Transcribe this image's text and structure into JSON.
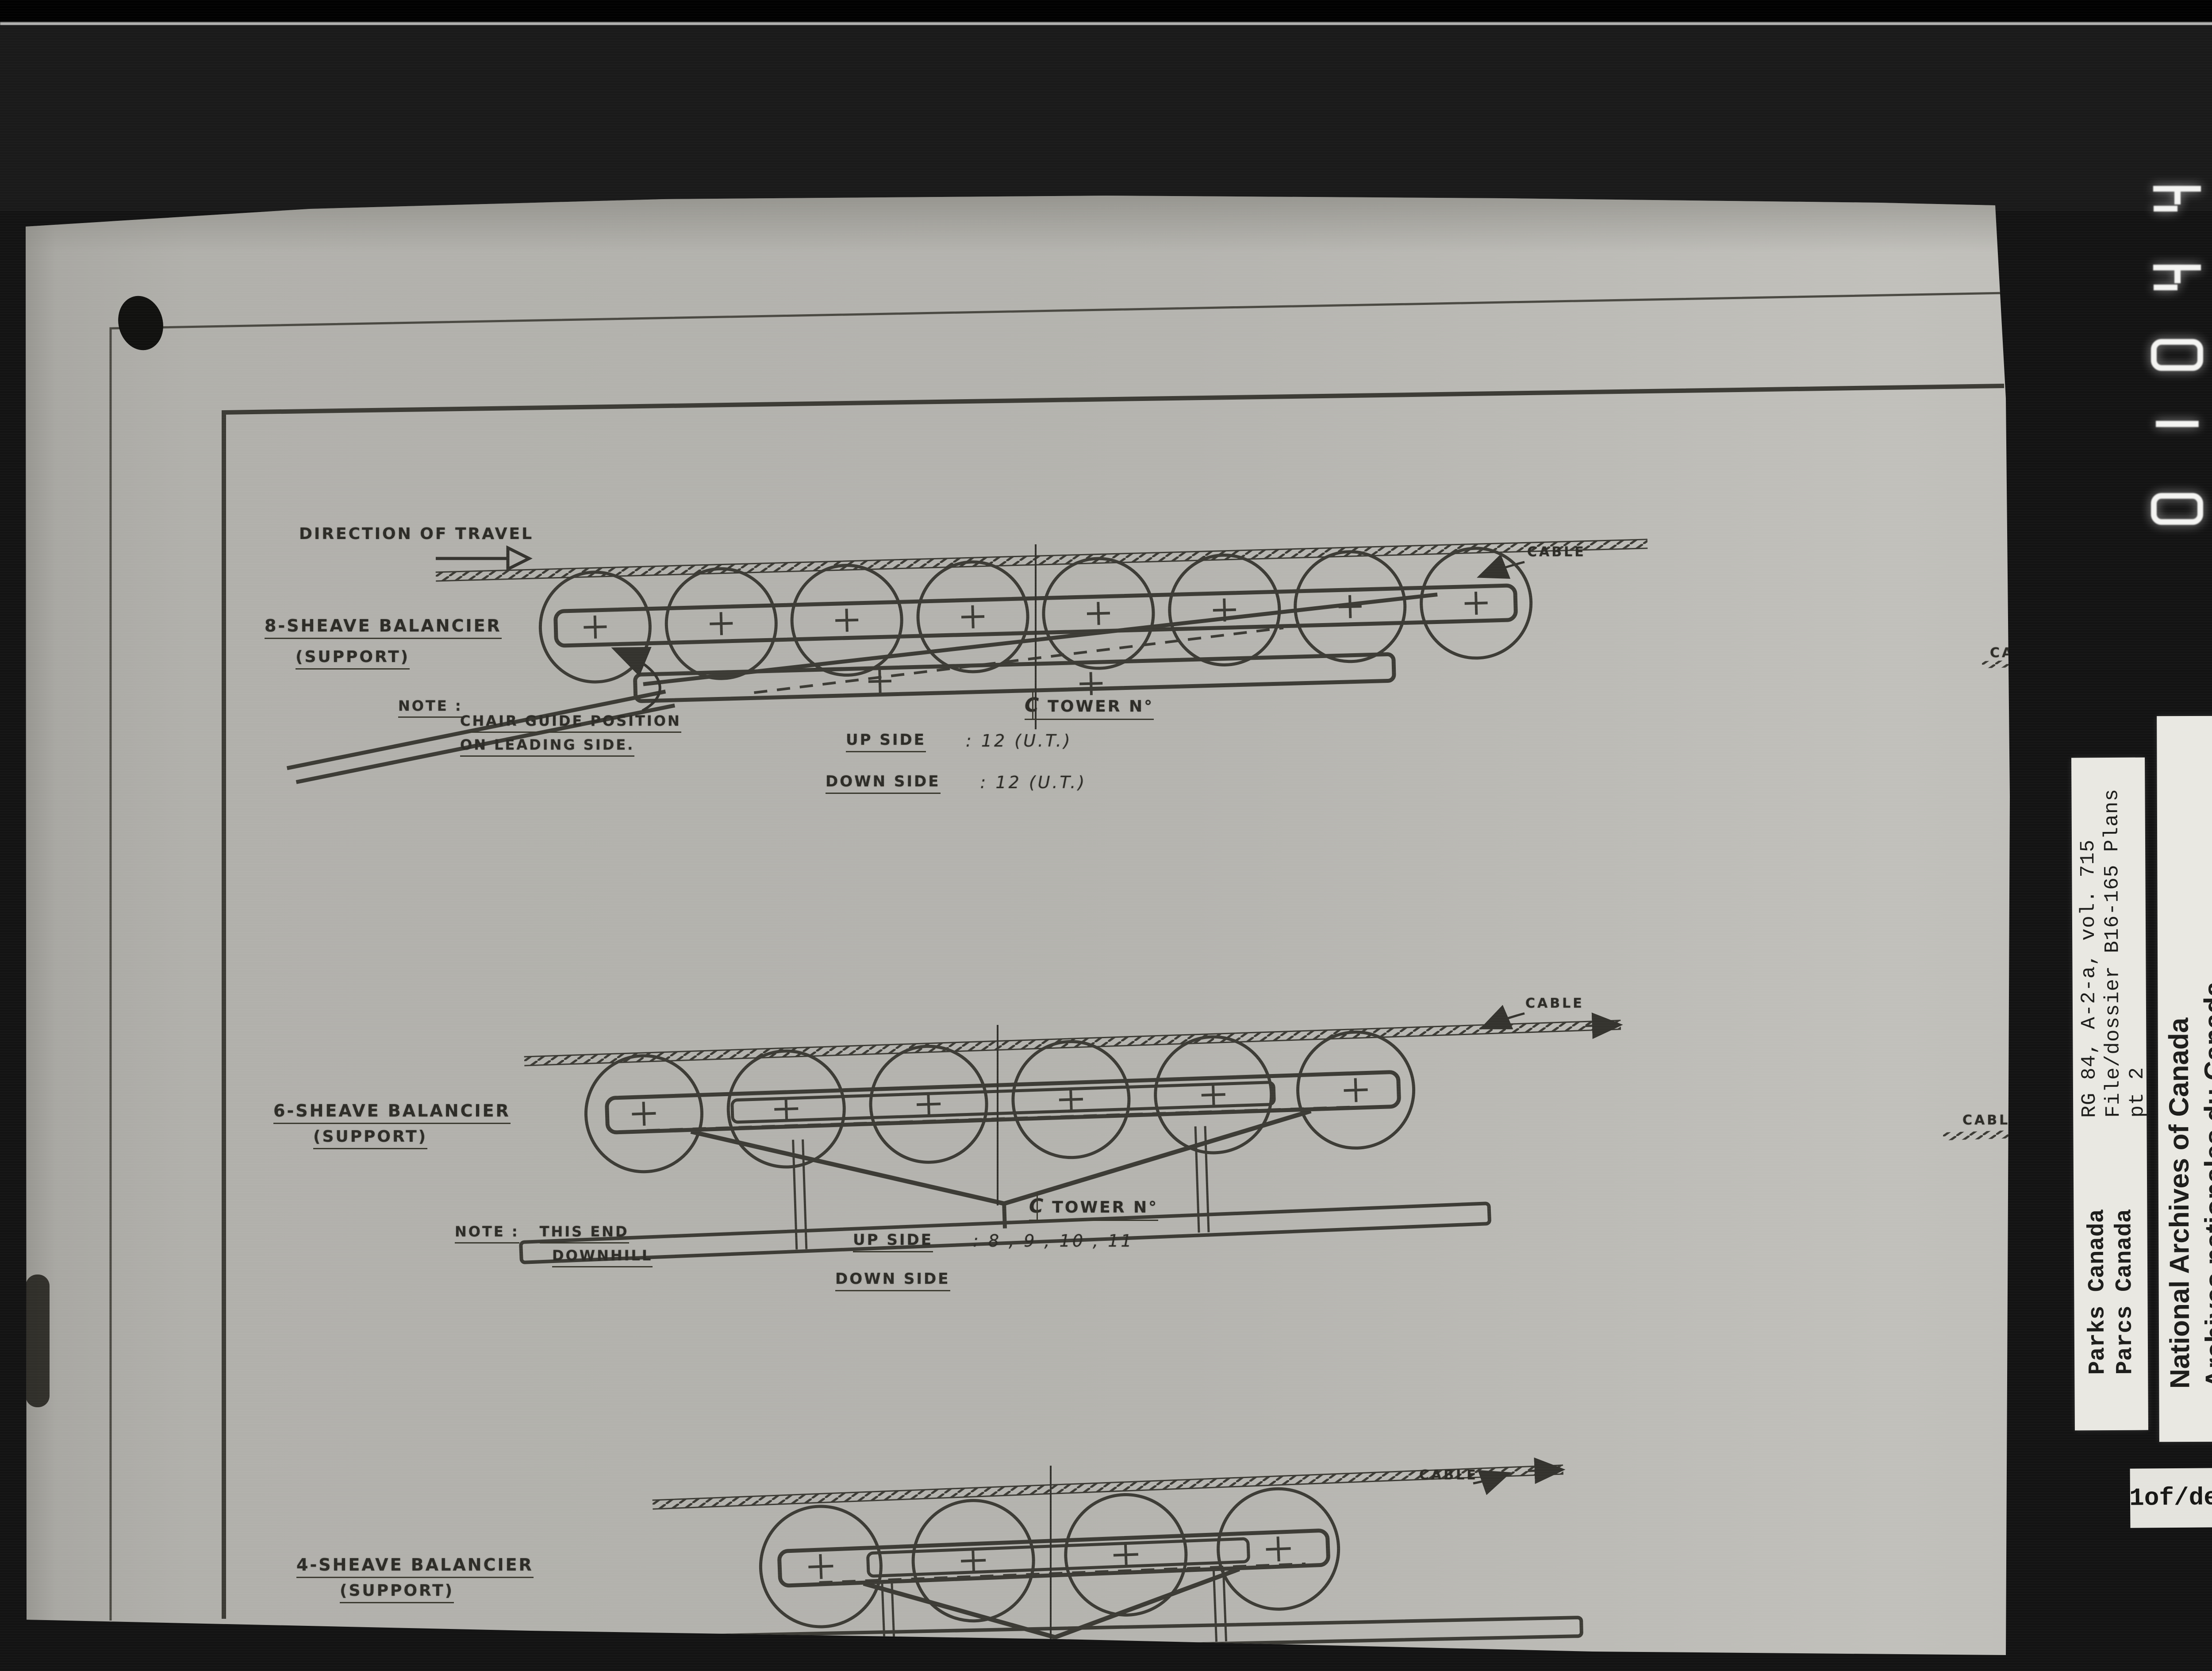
{
  "film": {
    "digits": [
      "4",
      "4",
      "0",
      "1",
      "0"
    ],
    "page_label": "1of/de"
  },
  "archive_labels": {
    "reference": [
      "RG 84, A-2-a, vol. 715",
      "File/dossier B16-165 Plans",
      "pt 2"
    ],
    "agency": [
      "Parks Canada",
      "Parcs Canada"
    ],
    "institution": [
      "National Archives of Canada",
      "Archives nationales du Canada"
    ]
  },
  "drawing": {
    "direction_label": "DIRECTION OF TRAVEL",
    "cable_label": "CABLE",
    "centerline_symbol": "C",
    "diagrams": [
      {
        "title": "8-SHEAVE BALANCIER",
        "subtitle": "(SUPPORT)",
        "tower_label": "TOWER  N°",
        "up_label": "UP  SIDE",
        "up_value": ":  12 (U.T.)",
        "down_label": "DOWN  SIDE",
        "down_value": ":  12 (U.T.)",
        "note_label": "NOTE :",
        "note_line1": "CHAIR GUIDE POSITION",
        "note_line2": "ON LEADING SIDE."
      },
      {
        "title": "6-SHEAVE BALANCIER",
        "subtitle": "(SUPPORT)",
        "tower_label": "TOWER  N°",
        "up_label": "UP  SIDE",
        "up_value": ":  8 , 9 , 10 , 11",
        "down_label": "DOWN  SIDE",
        "down_value": "",
        "note_label": "NOTE :",
        "note_line1": "THIS  END",
        "note_line2": "DOWNHILL"
      },
      {
        "title": "4-SHEAVE BALANCIER",
        "subtitle": "(SUPPORT)"
      }
    ]
  }
}
